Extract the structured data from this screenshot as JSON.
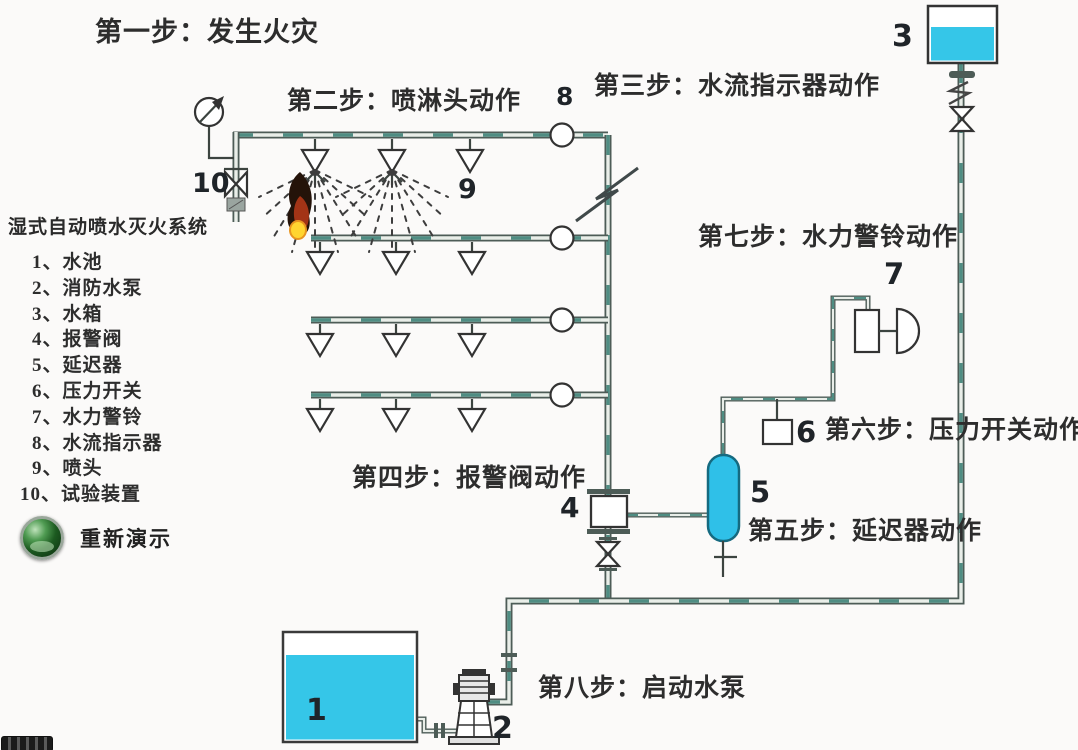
{
  "system": {
    "title": "湿式自动喷水灭火系统",
    "legend": [
      "1、水池",
      "2、消防水泵",
      "3、水箱",
      "4、报警阀",
      "5、延迟器",
      "6、压力开关",
      "7、水力警铃",
      "8、水流指示器",
      "9、喷头",
      "10、试验装置"
    ],
    "replay_label": "重新演示"
  },
  "steps": {
    "s1": "第一步：发生火灾",
    "s2": "第二步：喷淋头动作",
    "s3": "第三步：水流指示器动作",
    "s4": "第四步：报警阀动作",
    "s5": "第五步：延迟器动作",
    "s6": "第六步：压力开关动作",
    "s7": "第七步：水力警铃动作",
    "s8": "第八步：启动水泵"
  },
  "component_numbers": {
    "water_pool": "1",
    "fire_pump": "2",
    "water_tank": "3",
    "alarm_valve": "4",
    "delay_device": "5",
    "pressure_switch": "6",
    "hydraulic_alarm_bell": "7",
    "water_flow_indicator": "8",
    "sprinkler": "9",
    "test_device": "10"
  },
  "colors": {
    "water": "#35c6e8",
    "pipe_dark": "#4d5c57",
    "pipe_water_dash": "#4f8d83",
    "delay_device_fill": "#2fc0e8",
    "flame_base": "#ffd530",
    "replay_green": "#1c5a20"
  }
}
